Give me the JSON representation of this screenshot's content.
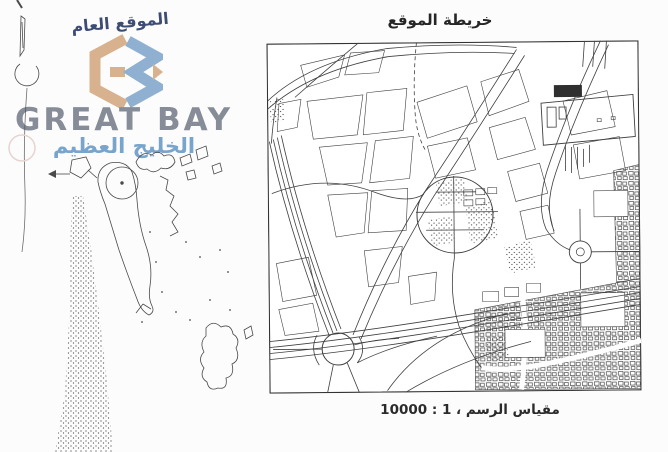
{
  "page": {
    "background": "#fcfcfc"
  },
  "branding": {
    "tagline_ar": "الموقع العام",
    "company_en": "GREAT BAY",
    "company_ar": "الخليج العظيم",
    "colors": {
      "monogram_tan": "#d8b28f",
      "monogram_blue": "#8fb0d0",
      "english_gray": "#868d98",
      "arabic_blue": "#79a4cc",
      "tagline_navy": "#3d4c74"
    }
  },
  "site_map": {
    "title": "خريطة الموقع",
    "scale_label": "مقياس الرسم ، 1 : 10000",
    "ink": "#3f3f3f"
  },
  "overview_map": {
    "ink": "#4a4a4a"
  }
}
